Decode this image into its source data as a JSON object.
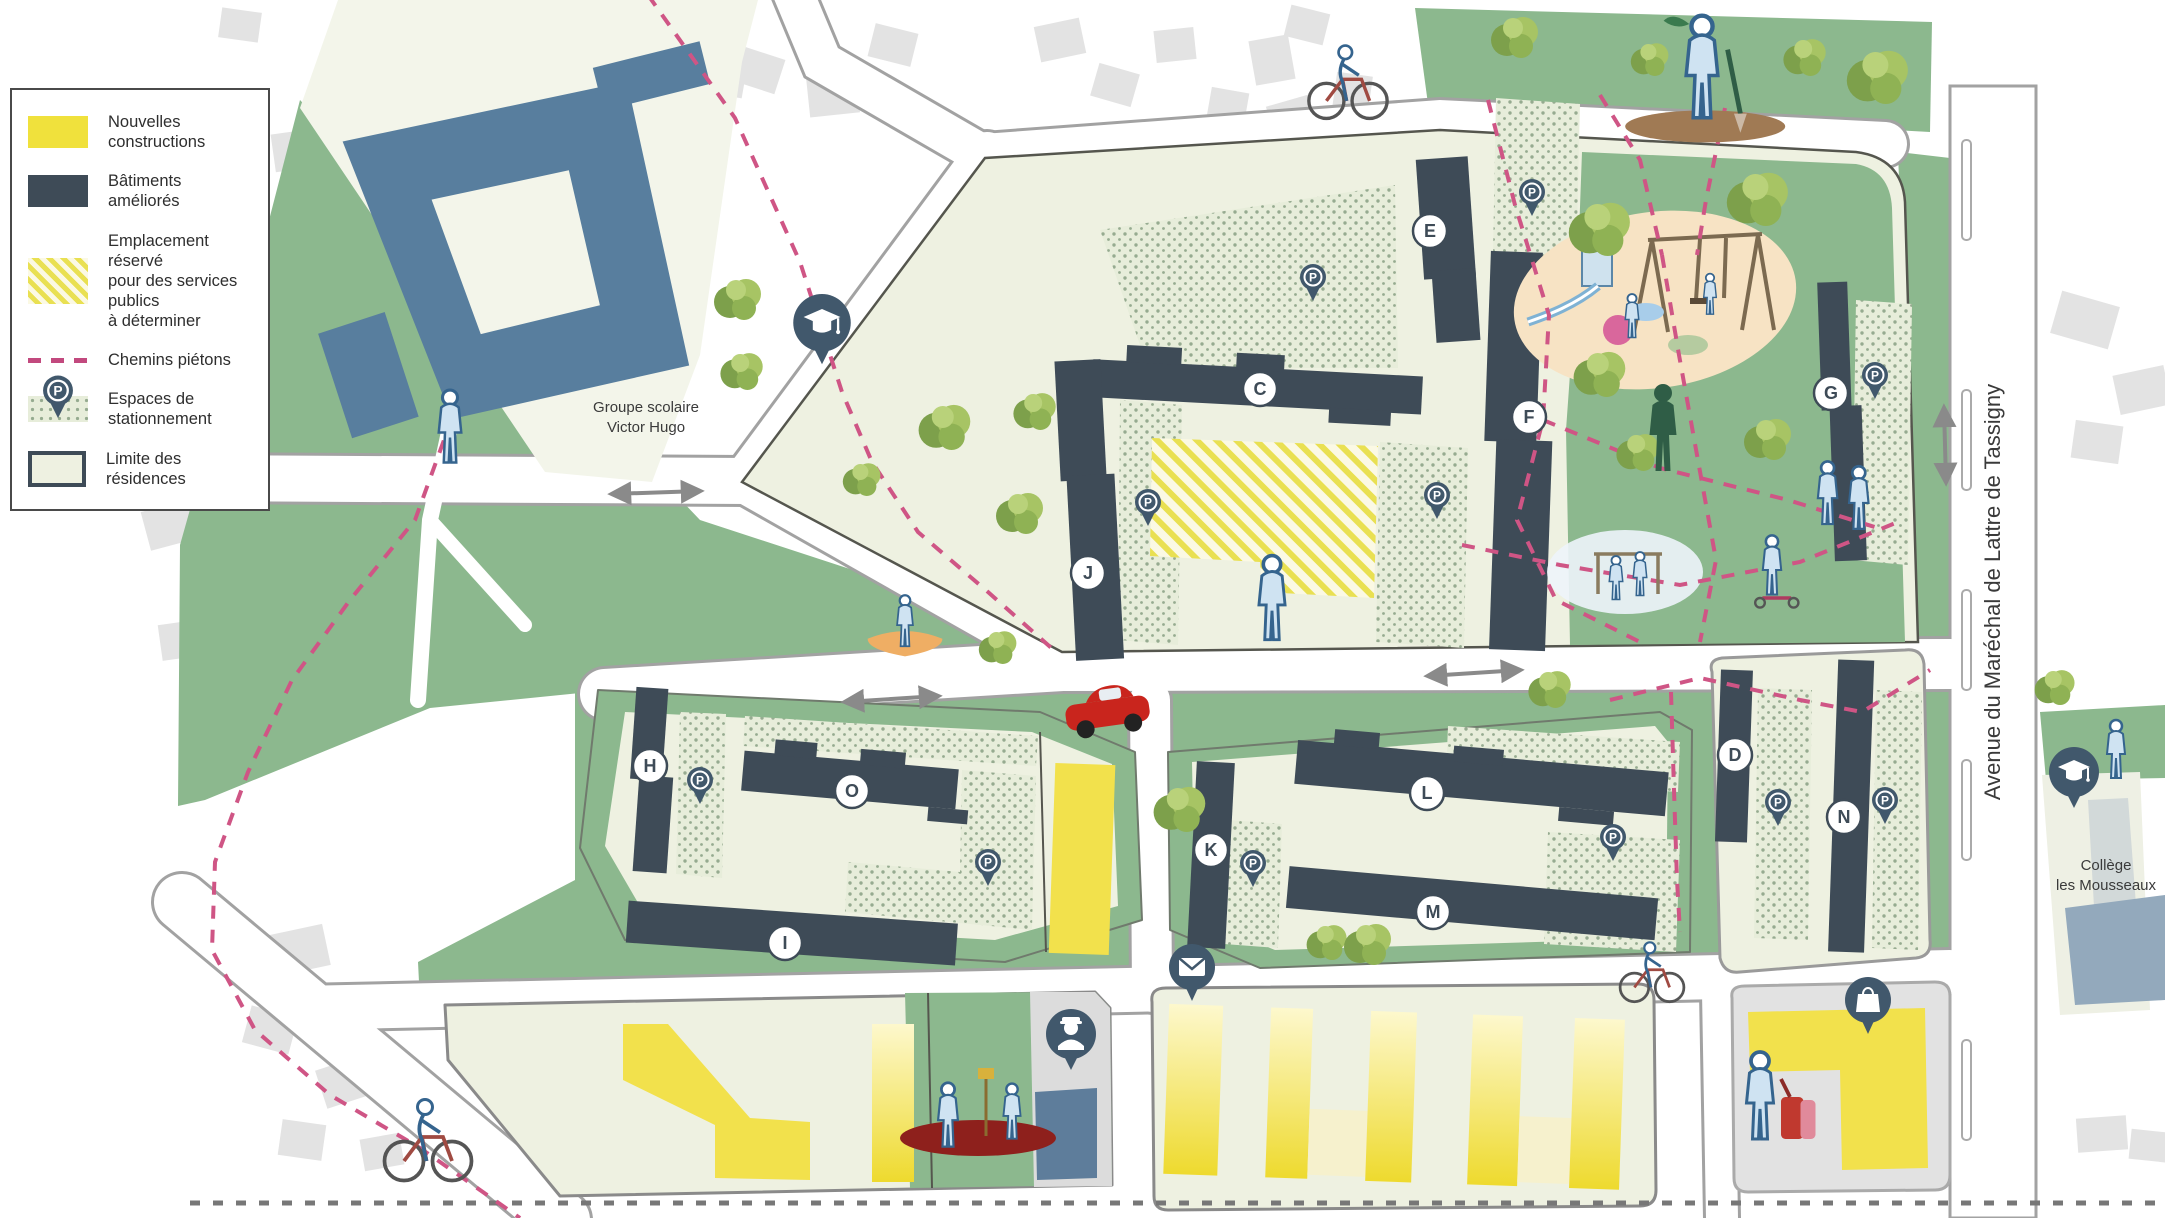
{
  "legend": {
    "items": [
      {
        "id": "new-constructions",
        "label": "Nouvelles constructions"
      },
      {
        "id": "improved-buildings",
        "label": "Bâtiments améliorés"
      },
      {
        "id": "reserved-public-services",
        "label": "Emplacement réservé\npour des services publics\nà déterminer"
      },
      {
        "id": "pedestrian-paths",
        "label": "Chemins piétons"
      },
      {
        "id": "parking-spaces",
        "label": "Espaces de\nstationnement"
      },
      {
        "id": "residence-limits",
        "label": "Limite des résidences"
      }
    ]
  },
  "labels": {
    "school_line1": "Groupe scolaire",
    "school_line2": "Victor Hugo",
    "avenue": "Avenue du Maréchal de Lattre de Tassigny",
    "college_line1": "Collège",
    "college_line2": "les Mousseaux",
    "parking_letter": "P"
  },
  "map": {
    "badges": [
      {
        "letter": "C",
        "x": 1260,
        "y": 389
      },
      {
        "letter": "E",
        "x": 1430,
        "y": 231
      },
      {
        "letter": "F",
        "x": 1529,
        "y": 417
      },
      {
        "letter": "G",
        "x": 1831,
        "y": 393
      },
      {
        "letter": "J",
        "x": 1088,
        "y": 573
      },
      {
        "letter": "H",
        "x": 650,
        "y": 766
      },
      {
        "letter": "O",
        "x": 852,
        "y": 791
      },
      {
        "letter": "I",
        "x": 785,
        "y": 943
      },
      {
        "letter": "K",
        "x": 1211,
        "y": 850
      },
      {
        "letter": "L",
        "x": 1427,
        "y": 793
      },
      {
        "letter": "M",
        "x": 1433,
        "y": 912
      },
      {
        "letter": "D",
        "x": 1735,
        "y": 755
      },
      {
        "letter": "N",
        "x": 1844,
        "y": 817
      }
    ],
    "parking_pins": [
      {
        "x": 1313,
        "y": 287
      },
      {
        "x": 1532,
        "y": 202
      },
      {
        "x": 1875,
        "y": 385
      },
      {
        "x": 1148,
        "y": 512
      },
      {
        "x": 1437,
        "y": 505
      },
      {
        "x": 700,
        "y": 790
      },
      {
        "x": 988,
        "y": 872
      },
      {
        "x": 1253,
        "y": 873
      },
      {
        "x": 1613,
        "y": 847
      },
      {
        "x": 1778,
        "y": 812
      },
      {
        "x": 1885,
        "y": 810
      }
    ],
    "amenity_pins": [
      {
        "icon": "graduation-cap",
        "x": 822,
        "y": 332,
        "s": 1.15
      },
      {
        "icon": "graduation-cap",
        "x": 2074,
        "y": 780,
        "s": 1.0
      },
      {
        "icon": "mail",
        "x": 1192,
        "y": 975,
        "s": 1.0
      },
      {
        "icon": "police",
        "x": 1071,
        "y": 1042,
        "s": 1.0
      },
      {
        "icon": "shopping-bag",
        "x": 1868,
        "y": 1008,
        "s": 1.0
      }
    ],
    "trees": [
      {
        "x": 738,
        "y": 300,
        "s": 1.0
      },
      {
        "x": 742,
        "y": 372,
        "s": 0.9
      },
      {
        "x": 862,
        "y": 480,
        "s": 0.8
      },
      {
        "x": 945,
        "y": 428,
        "s": 1.1
      },
      {
        "x": 1035,
        "y": 412,
        "s": 0.9
      },
      {
        "x": 1020,
        "y": 514,
        "s": 1.0
      },
      {
        "x": 998,
        "y": 648,
        "s": 0.8
      },
      {
        "x": 1515,
        "y": 38,
        "s": 1.0
      },
      {
        "x": 1650,
        "y": 60,
        "s": 0.8
      },
      {
        "x": 1805,
        "y": 58,
        "s": 0.9
      },
      {
        "x": 1878,
        "y": 78,
        "s": 1.3
      },
      {
        "x": 1600,
        "y": 230,
        "s": 1.3
      },
      {
        "x": 1758,
        "y": 200,
        "s": 1.3
      },
      {
        "x": 1600,
        "y": 375,
        "s": 1.1
      },
      {
        "x": 1638,
        "y": 453,
        "s": 0.9
      },
      {
        "x": 1768,
        "y": 440,
        "s": 1.0
      },
      {
        "x": 1180,
        "y": 810,
        "s": 1.1
      },
      {
        "x": 1327,
        "y": 943,
        "s": 0.85
      },
      {
        "x": 1368,
        "y": 945,
        "s": 1.0
      },
      {
        "x": 1550,
        "y": 690,
        "s": 0.9
      },
      {
        "x": 2055,
        "y": 688,
        "s": 0.85
      }
    ],
    "figures": [
      {
        "kind": "gardener",
        "x": 1702,
        "y": 72,
        "s": 1.6
      },
      {
        "kind": "cyclist",
        "x": 1348,
        "y": 82,
        "s": 1.35
      },
      {
        "kind": "person",
        "x": 450,
        "y": 430,
        "s": 1.25
      },
      {
        "kind": "sandbox",
        "x": 905,
        "y": 630,
        "s": 1.1
      },
      {
        "kind": "person",
        "x": 1272,
        "y": 602,
        "s": 1.45
      },
      {
        "kind": "darkwalker",
        "x": 1663,
        "y": 432,
        "s": 1.5
      },
      {
        "kind": "monkeybars",
        "x": 1628,
        "y": 572,
        "s": 1.0
      },
      {
        "kind": "scooter",
        "x": 1772,
        "y": 568,
        "s": 1.2
      },
      {
        "kind": "couple",
        "x": 1842,
        "y": 496,
        "s": 1.2
      },
      {
        "kind": "cyclist",
        "x": 1652,
        "y": 972,
        "s": 1.1
      },
      {
        "kind": "basketball",
        "x": 978,
        "y": 1138,
        "s": 1.0
      },
      {
        "kind": "suitcase-person",
        "x": 1760,
        "y": 1100,
        "s": 1.5
      },
      {
        "kind": "cyclist",
        "x": 428,
        "y": 1140,
        "s": 1.5
      },
      {
        "kind": "person",
        "x": 2116,
        "y": 752,
        "s": 1.0
      }
    ],
    "arrows": [
      {
        "x1": 612,
        "y1": 494,
        "x2": 700,
        "y2": 491
      },
      {
        "x1": 845,
        "y1": 702,
        "x2": 938,
        "y2": 696
      },
      {
        "x1": 1428,
        "y1": 676,
        "x2": 1520,
        "y2": 670
      },
      {
        "x1": 1944,
        "y1": 408,
        "x2": 1946,
        "y2": 482
      }
    ]
  },
  "colors": {
    "new_construction": "#f2e14c",
    "improved_building": "#3e4b57",
    "reserved_hatch": "#e9e052",
    "pedestrian_path": "#cf5585",
    "parking_dot": "#96ab90",
    "residence_fill": "#eef1e1",
    "lawn_green": "#8cb88e",
    "school_blue": "#587e9e",
    "pin_blue": "#41586c",
    "college_blue": "#93a9bc"
  }
}
